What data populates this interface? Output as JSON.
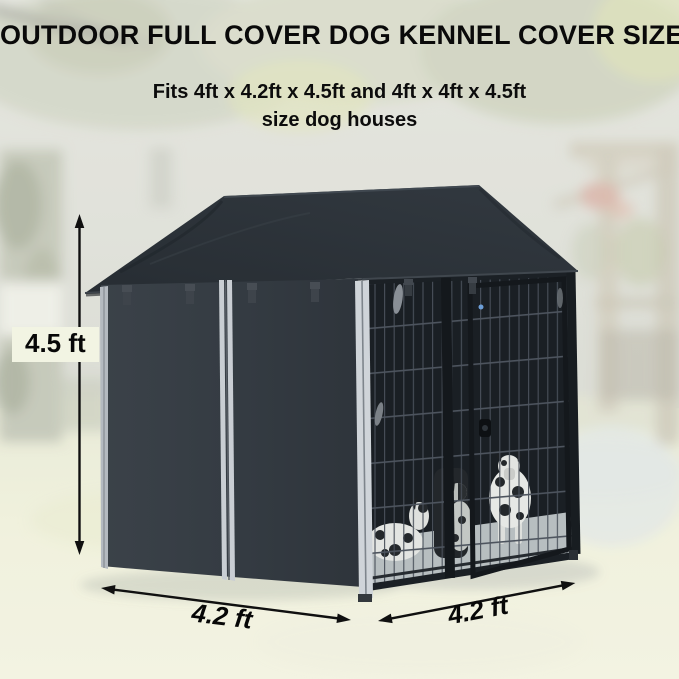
{
  "header": {
    "title": "OUTDOOR FULL COVER DOG KENNEL COVER SIZE",
    "subtitle_line1": "Fits 4ft x 4.2ft x 4.5ft and 4ft x 4ft x 4.5ft",
    "subtitle_line2": "size dog houses"
  },
  "dimensions": {
    "height": "4.5 ft",
    "width": "4.2 ft",
    "depth": "4.2 ft"
  },
  "theme": {
    "cover_color": "#31373e",
    "roof_color": "#2b3137",
    "trim_color": "#c9ced3",
    "wire_panel_color": "#1a1f24",
    "annotation_color": "#101010",
    "height_label_bg": "#f2f4e3",
    "ground_color": "#f0f0dc"
  }
}
